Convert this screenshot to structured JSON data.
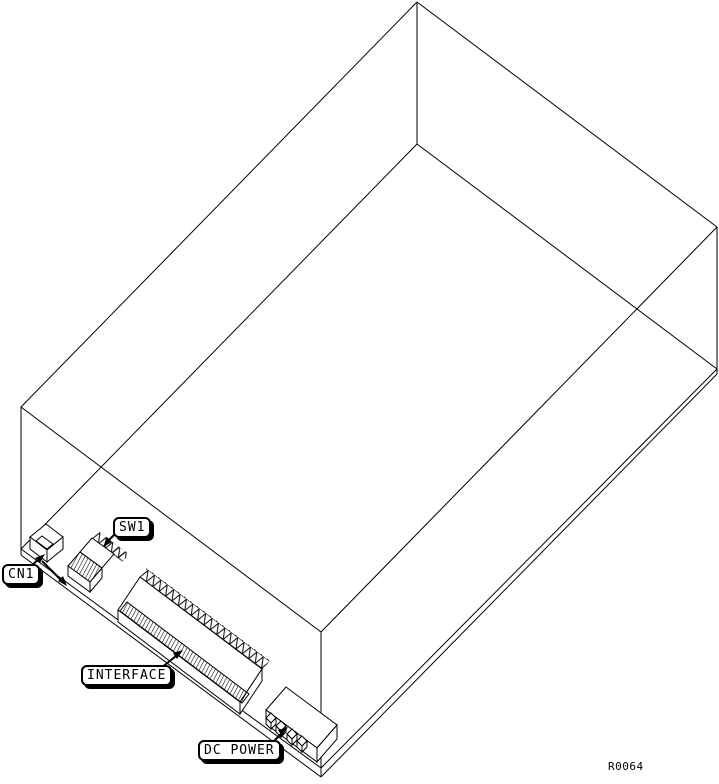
{
  "figure": {
    "drawing_ref": "R0064",
    "callouts": [
      {
        "id": "cn1",
        "label": "CN1"
      },
      {
        "id": "sw1",
        "label": "SW1"
      },
      {
        "id": "interface",
        "label": "INTERFACE"
      },
      {
        "id": "dc_power",
        "label": "DC POWER"
      }
    ],
    "colors": {
      "line": "#000000",
      "background": "#ffffff",
      "label_background": "#ffffff",
      "label_border": "#000000"
    }
  }
}
